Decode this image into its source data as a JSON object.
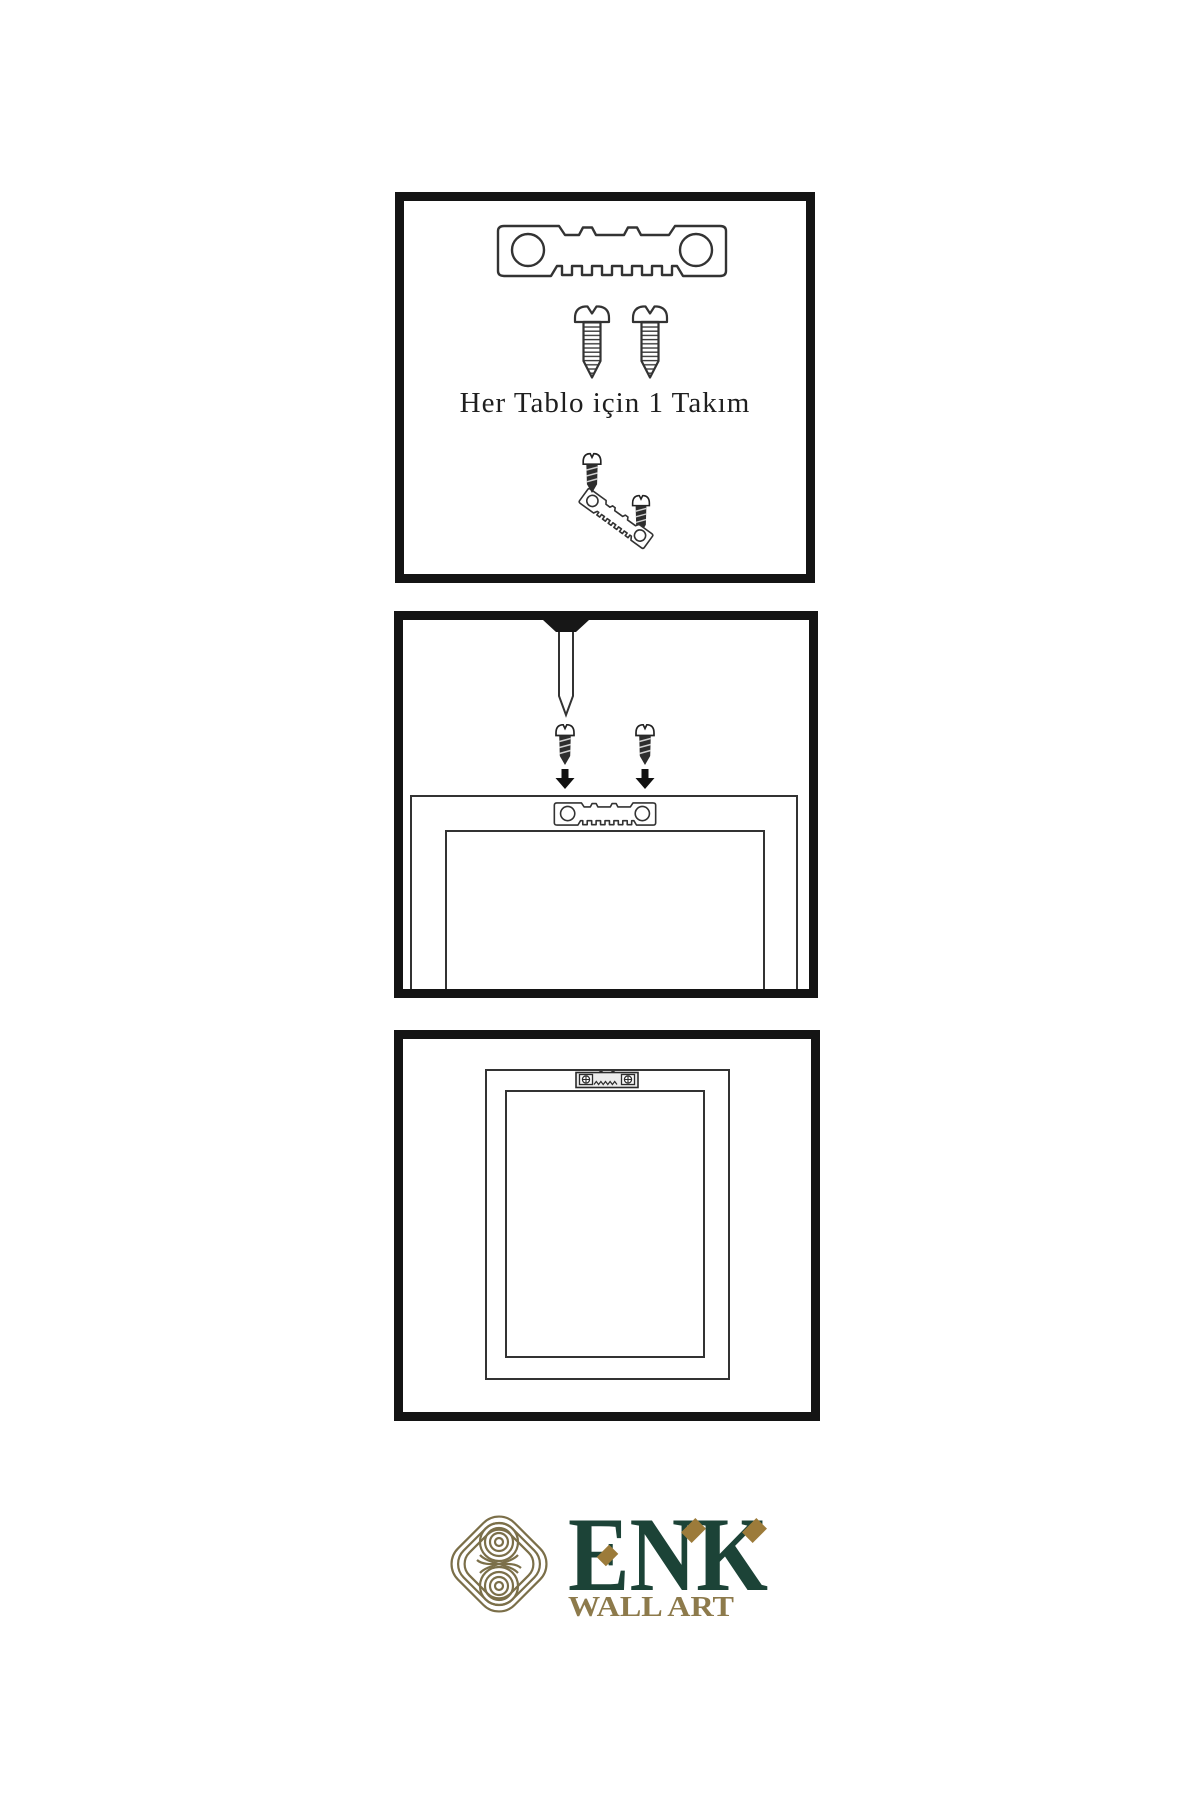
{
  "page": {
    "background_color": "#ffffff",
    "panel_border_color": "#141414",
    "line_color": "#333333",
    "ink_color": "#1f1f1f"
  },
  "steps": {
    "kit": {
      "caption": "Her Tablo için 1 Takım"
    },
    "mount": {
      "description_visible_text": ""
    },
    "hang": {
      "description_visible_text": ""
    }
  },
  "brand": {
    "name": "ENK",
    "tagline": "WALL ART",
    "colors": {
      "name_color": "#1c4337",
      "tagline_color": "#8d7a4b",
      "knot_color": "#7b6f49",
      "diamond_color": "#9c7b3a"
    }
  }
}
